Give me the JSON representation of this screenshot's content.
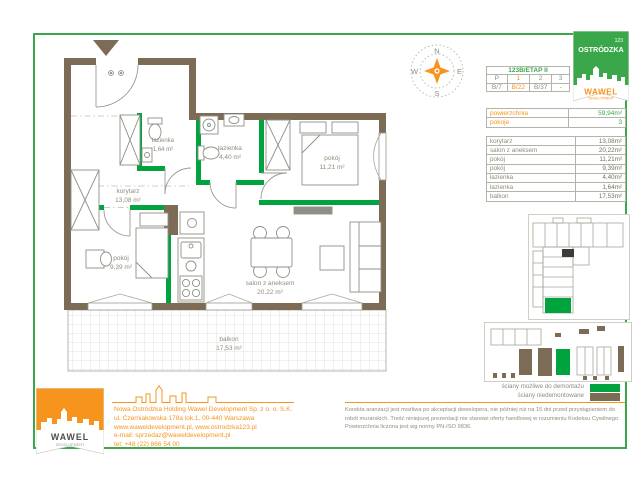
{
  "colors": {
    "wall_brown": "#7C6B55",
    "wall_green": "#00A33E",
    "brand_green": "#3AA74B",
    "brand_orange": "#F7941D"
  },
  "badge_right": {
    "project_number": "123",
    "project_name": "OSTRÓDZKA",
    "brand": "WAWEL",
    "brand_sub": "DEVELOPMENT"
  },
  "unit_table": {
    "title": "123B/ETAP II",
    "row_floors": [
      "P",
      "1",
      "2",
      "3"
    ],
    "row_units": [
      "B/7",
      "B/22",
      "B/37",
      "-"
    ]
  },
  "summary": {
    "area_label": "powierzchnia",
    "area_value": "59,94m²",
    "rooms_label": "pokoje",
    "rooms_value": "3"
  },
  "rooms_table": {
    "rows": [
      {
        "label": "korytarz",
        "value": "13,08m²"
      },
      {
        "label": "salon z aneksem",
        "value": "20,22m²"
      },
      {
        "label": "pokój",
        "value": "11,21m²"
      },
      {
        "label": "pokój",
        "value": "9,39m²"
      },
      {
        "label": "łazienka",
        "value": "4,40m²"
      },
      {
        "label": "łazienka",
        "value": "1,64m²"
      },
      {
        "label": "balkon",
        "value": "17,53m²"
      }
    ]
  },
  "plan_labels": {
    "korytarz": {
      "name": "korytarz",
      "area": "13,08 m²"
    },
    "bath_small": {
      "name": "łazienka",
      "area": "1,64 m²"
    },
    "bath_large": {
      "name": "łazienka",
      "area": "4,40 m²"
    },
    "room_large": {
      "name": "pokój",
      "area": "11,21 m²"
    },
    "room_small": {
      "name": "pokój",
      "area": "9,39 m²"
    },
    "salon": {
      "name": "salon z aneksem",
      "area": "20,22 m²"
    },
    "balcony": {
      "name": "balkon",
      "area": "17,53 m²"
    }
  },
  "compass": {
    "north": "N",
    "east": "E",
    "south": "S",
    "west": "W"
  },
  "legend": {
    "demountable": "ściany możliwe do demontażu",
    "fixed": "ściany niedemontowane"
  },
  "footer": {
    "brand": "WAWEL",
    "brand_sub": "DEVELOPMENT",
    "address_lines": [
      "Nowa Ostródzka Holding Wawel Development Sp. z o. o. S.K.",
      "ul. Czerniakowska 178a lok.1, 00-440 Warszawa",
      "www.waweldevelopment.pl, www.ostrodzka123.pl",
      "e-mail: sprzedaz@waweldevelopment.pl",
      "tel: +48 (22) 866 54 00"
    ],
    "disclaimer_lines": [
      "Korekta aranżacji jest możliwa po akceptacji dewelopera, nie później niż na 15 dni przed przystąpieniem do",
      "robót murarskich. Treść niniejszej prezentacji nie stanowi oferty handlowej w rozumieniu Kodeksu Cywilnego.",
      "Powierzchnia liczona jest wg normy PN-ISO 9836."
    ]
  }
}
